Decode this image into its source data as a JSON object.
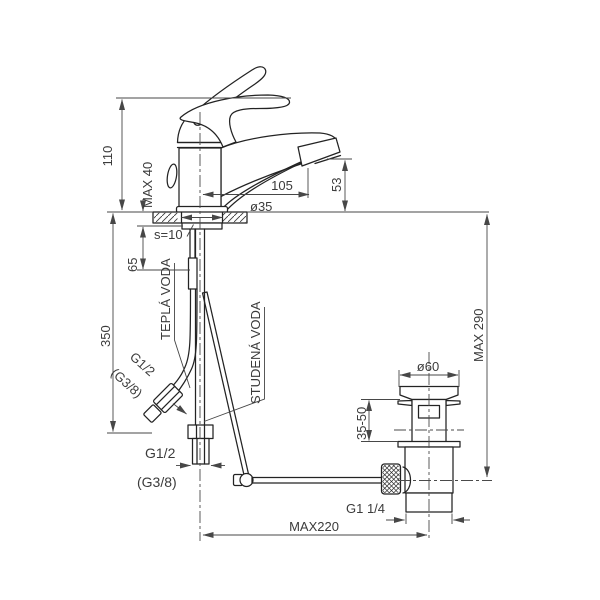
{
  "title": "Basin mixer with pop-up drain — dimensioned technical drawing",
  "colors": {
    "background": "#ffffff",
    "object_line": "#232323",
    "dimension_line": "#474747",
    "text": "#3b3b3b"
  },
  "dimensions": {
    "body_height": "110",
    "deck_max_thickness": "MAX 40",
    "spout_reach": "105",
    "spout_outlet_height": "53",
    "deck_hole_diameter": "ø35",
    "base_plate_thickness": "s=10",
    "shank_length": "65",
    "supply_length": "350",
    "hot_water_label": "TEPLÁ VODA",
    "cold_water_label": "STUDENÁ VODA",
    "supply_thread_diag": "G1/2",
    "supply_thread_diag_alt": "(G3/8)",
    "supply_thread_bottom": "G1/2",
    "supply_thread_bottom_alt": "(G3/8)",
    "drain_max_height": "MAX 290",
    "drain_flange_diameter": "ø60",
    "drain_clamp_range": "35-50",
    "drain_thread": "G1 1/4",
    "rod_max_reach": "MAX220"
  }
}
